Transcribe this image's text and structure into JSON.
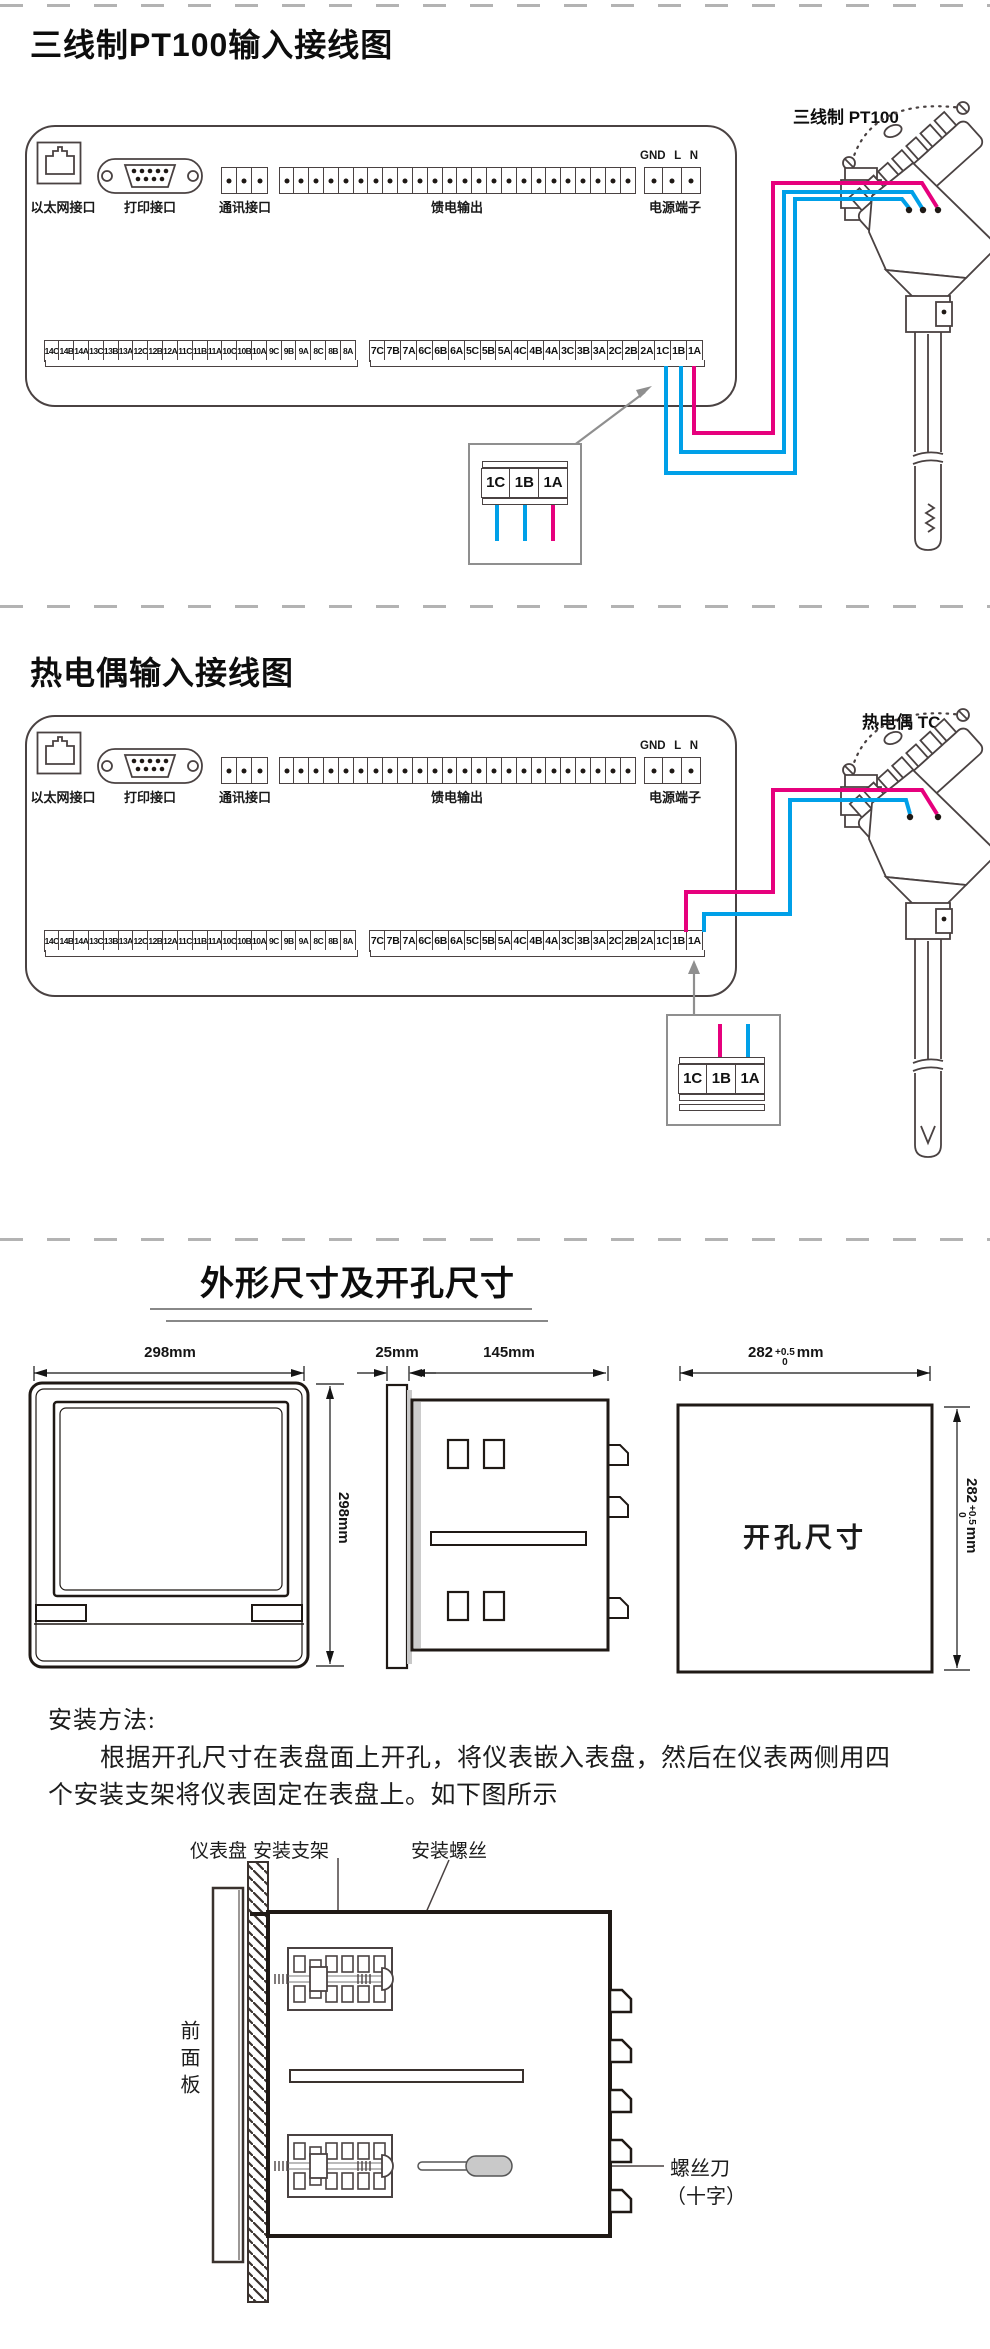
{
  "colors": {
    "wire_hot": "#e6007d",
    "wire_cold": "#00a0e8",
    "cutout_fill": "#dcdcdc",
    "handle_fill": "#c9c9c9"
  },
  "pt100": {
    "title": "三线制PT100输入接线图",
    "sensor_label": "三线制 PT100"
  },
  "tc": {
    "title": "热电偶输入接线图",
    "sensor_label": "热电偶 TC"
  },
  "panel": {
    "ethernet_label": "以太网接口",
    "printer_label": "打印接口",
    "comm_label": "通讯接口",
    "feed_label": "馈电输出",
    "power_label": "电源端子",
    "power_pins": [
      "GND",
      "L",
      "N"
    ],
    "terminals_left": [
      "14C",
      "14B",
      "14A",
      "13C",
      "13B",
      "13A",
      "12C",
      "12B",
      "12A",
      "11C",
      "11B",
      "11A",
      "10C",
      "10B",
      "10A",
      "9C",
      "9B",
      "9A",
      "8C",
      "8B",
      "8A"
    ],
    "terminals_right": [
      "7C",
      "7B",
      "7A",
      "6C",
      "6B",
      "6A",
      "5C",
      "5B",
      "5A",
      "4C",
      "4B",
      "4A",
      "3C",
      "3B",
      "3A",
      "2C",
      "2B",
      "2A",
      "1C",
      "1B",
      "1A"
    ],
    "detail_terminals": [
      "1C",
      "1B",
      "1A"
    ]
  },
  "dims": {
    "title": "外形尺寸及开孔尺寸",
    "front_width": "298mm",
    "front_height": "298mm",
    "bezel_depth": "25mm",
    "body_depth": "145mm",
    "cutout_value": "282",
    "cutout_tol_plus": "+0.5",
    "cutout_tol_minus": "0",
    "cutout_unit": "mm",
    "cutout_area_label": "开孔尺寸"
  },
  "install": {
    "heading": "安装方法:",
    "line1": "根据开孔尺寸在表盘面上开孔，将仪表嵌入表盘，然后在仪表两侧用四",
    "line2": "个安装支架将仪表固定在表盘上。如下图所示",
    "label_panel_board": "仪表盘",
    "label_bracket": "安装支架",
    "label_screw": "安装螺丝",
    "label_front_panel": "前面板",
    "label_screwdriver_line1": "螺丝刀",
    "label_screwdriver_line2": "（十字）"
  }
}
